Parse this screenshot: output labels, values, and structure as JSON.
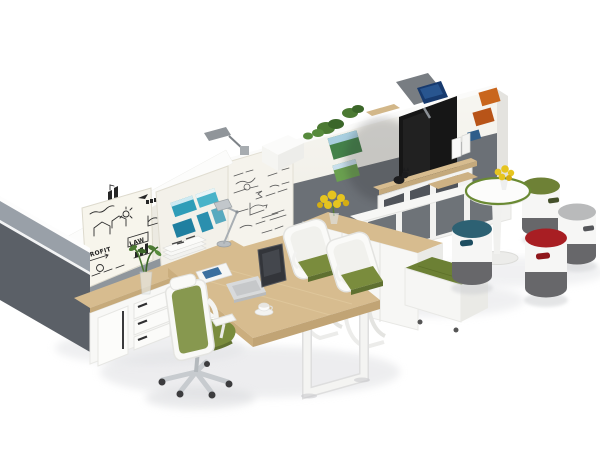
{
  "meta": {
    "title": "Open plan office workspace",
    "scene_type": "3d furniture product render on white background"
  },
  "palette": {
    "panel_dark": "#5b6067",
    "panel_light": "#99a0a8",
    "wall_white": "#f4f2ec",
    "wall_gray_band": "#6b7076",
    "wood": "#d7bc8f",
    "wood_edge": "#c3a374",
    "furniture_white": "#f8f8f6",
    "chair_green": "#7a8c3d",
    "bench_green": "#6c8034",
    "tv_black": "#161616",
    "stool_blue": "#2d6173",
    "stool_green": "#6e8136",
    "stool_gray": "#b9babb",
    "stool_red": "#a81e23",
    "stool_base": "#67676a",
    "table_rim": "#6a8a33",
    "flower_yellow": "#e6c41f",
    "plant_green": "#4c7a33",
    "chrome": "#a8aeb3"
  },
  "whiteboard": {
    "word_profit": "PROFIT",
    "word_law": "LAW"
  },
  "objects": [
    {
      "name": "acoustic-end-panel",
      "desc": "dark gray fabric partition panel at left end"
    },
    {
      "name": "sketch-whiteboard",
      "desc": "markerboard with hand-drawn houses, charts, PROFIT and LAW"
    },
    {
      "name": "photo-panel",
      "desc": "partition pinned with teal beach photos"
    },
    {
      "name": "formula-whiteboard",
      "desc": "tall partition with handwritten formulas"
    },
    {
      "name": "left-credenza",
      "desc": "white credenza with oak top, door and three drawers"
    },
    {
      "name": "desk",
      "desc": "L-shaped oak desk with white O-frame legs"
    },
    {
      "name": "laptop",
      "desc": "open silver laptop with dark screen"
    },
    {
      "name": "desk-lamp",
      "desc": "chrome articulated desk lamp"
    },
    {
      "name": "wall-lamp",
      "desc": "gray task lamp mounted on partition top"
    },
    {
      "name": "magazines",
      "desc": "stack of newspapers and a magazine"
    },
    {
      "name": "coffee-cup",
      "desc": "white cup on saucer"
    },
    {
      "name": "task-chair",
      "desc": "white ergonomic chair with green mesh and headrest"
    },
    {
      "name": "visitor-chairs",
      "count": 2,
      "desc": "white cantilever chairs with green seats"
    },
    {
      "name": "media-wall",
      "desc": "white and gray partition with wall-mounted TV, oak shelf, low cabinets"
    },
    {
      "name": "tv",
      "desc": "large black flat-screen TV"
    },
    {
      "name": "back-monitor",
      "desc": "monitor mounted on reverse side of wall"
    },
    {
      "name": "bench-credenza",
      "desc": "white storage with oak top, yellow flowers and green cushioned bench"
    },
    {
      "name": "round-table",
      "desc": "white pedestal table with green rim and yellow flowers"
    },
    {
      "name": "stools",
      "count": 4,
      "desc": "cylindrical stools, white body, dark base",
      "top_colors": [
        "blue",
        "green",
        "gray",
        "red"
      ]
    },
    {
      "name": "plants",
      "desc": "green plants in glass vases and on wall-top planters"
    }
  ]
}
